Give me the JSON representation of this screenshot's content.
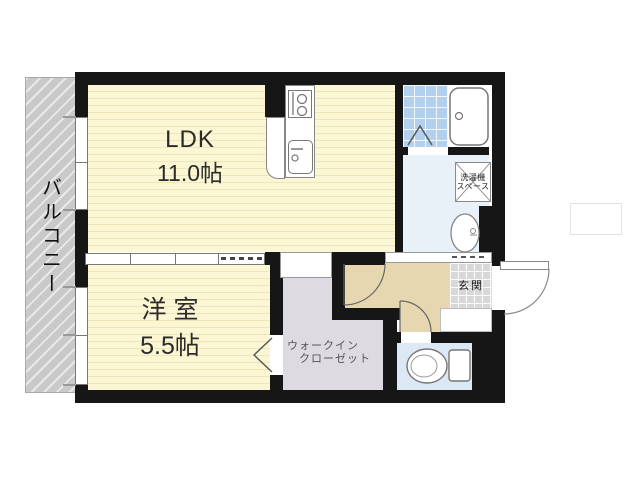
{
  "floor_plan": {
    "balcony": {
      "label": "バルコニー"
    },
    "ldk": {
      "label": "LDK",
      "size": "11.0帖"
    },
    "western_room": {
      "label": "洋室",
      "size": "5.5帖"
    },
    "walk_in_closet": {
      "label_line1": "ウォークイン",
      "label_line2": "クローゼット"
    },
    "laundry_space": {
      "label_line1": "洗濯機",
      "label_line2": "スペース"
    },
    "entrance": {
      "label": "玄関"
    },
    "colors": {
      "wall": "#161616",
      "room_floor_yellow": "#fbf6d3",
      "balcony_gray": "#c9c9c9",
      "hallway_tan": "#e7d7b0",
      "closet_lavender": "#dedae2",
      "washroom_blue": "#e8f0f8",
      "toilet_blue": "#dce8f4",
      "bath_tile_blue": "#b3d0ef",
      "entrance_tile_gray": "#d8d8d8"
    }
  }
}
